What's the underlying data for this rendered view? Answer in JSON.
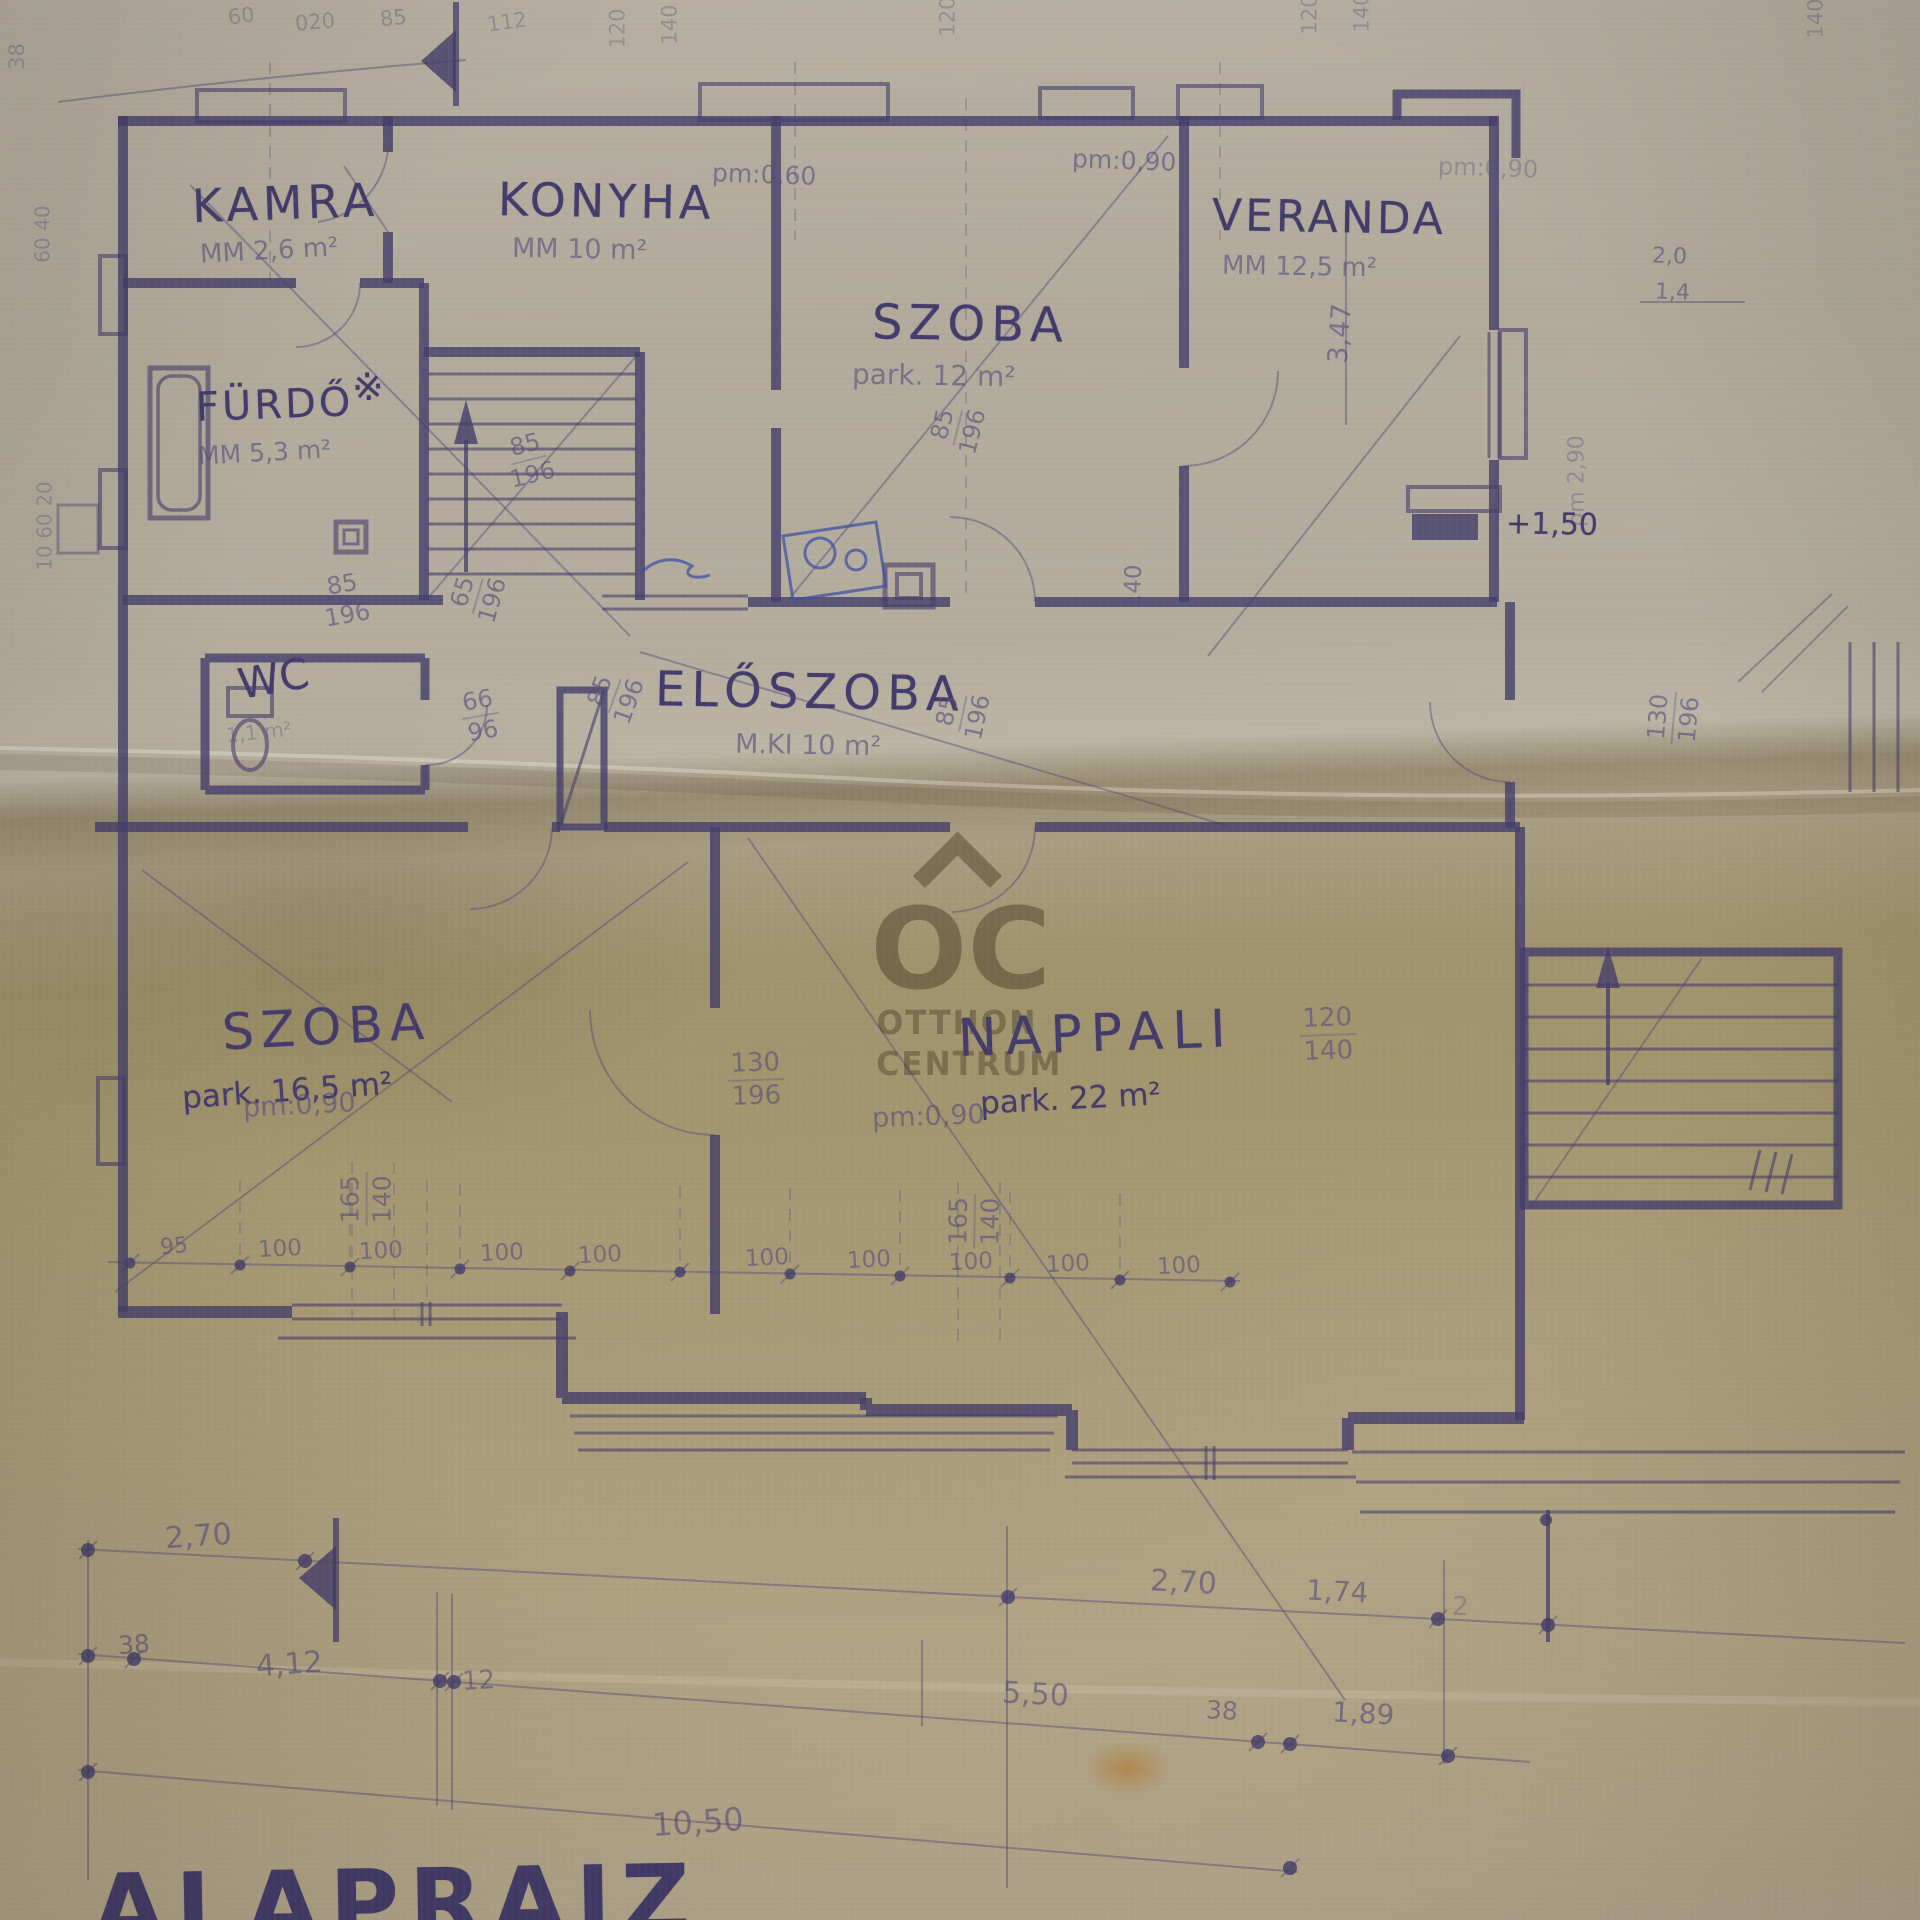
{
  "watermark": {
    "logo": "OC",
    "line1": "OTTHON",
    "line2": "CENTRUM"
  },
  "title": "ALAPRAJZ",
  "rooms": {
    "kamra": {
      "name": "KAMRA",
      "area": "MM 2,6 m²"
    },
    "konyha": {
      "name": "KONYHA",
      "area": "MM 10 m²"
    },
    "szoba_felso": {
      "name": "SZOBA",
      "area": "park. 12 m²"
    },
    "veranda": {
      "name": "VERANDA",
      "area": "MM 12,5 m²"
    },
    "furdo": {
      "name": "FÜRDŐ",
      "area": "MM 5,3 m²"
    },
    "wc": {
      "name": "WC",
      "area": "1,1 m²"
    },
    "eloszoba": {
      "name": "ELŐSZOBA",
      "area": "M.KI 10 m²"
    },
    "szoba_also": {
      "name": "SZOBA",
      "area": "park. 16,5 m²"
    },
    "nappali": {
      "name": "NAPPALI",
      "area": "park. 22 m²"
    }
  },
  "levels": {
    "veranda_level": "+1,50"
  },
  "heights": {
    "pm_090": "pm:0,90",
    "pm_060": "pm:0,60",
    "pm_290": "pm 2,90"
  },
  "dims": {
    "n85": "85",
    "n196": "196",
    "n65": "65",
    "n66": "66",
    "n96": "96",
    "n95": "95",
    "n100": "100",
    "n120": "120",
    "n130": "130",
    "n140": "140",
    "n165": "165",
    "n12": "12",
    "n38": "38",
    "n2": "2",
    "d20": "2,0",
    "d14": "1,4",
    "n20e": "20",
    "n40": "40",
    "n60": "60",
    "n10": "10",
    "n020": "020",
    "n112": "112",
    "d270": "2,70",
    "d174": "1,74",
    "d412": "4,12",
    "d550": "5,50",
    "d189": "1,89",
    "d1050": "10,50",
    "d347": "3,47"
  },
  "symbols": {
    "star": "※"
  }
}
